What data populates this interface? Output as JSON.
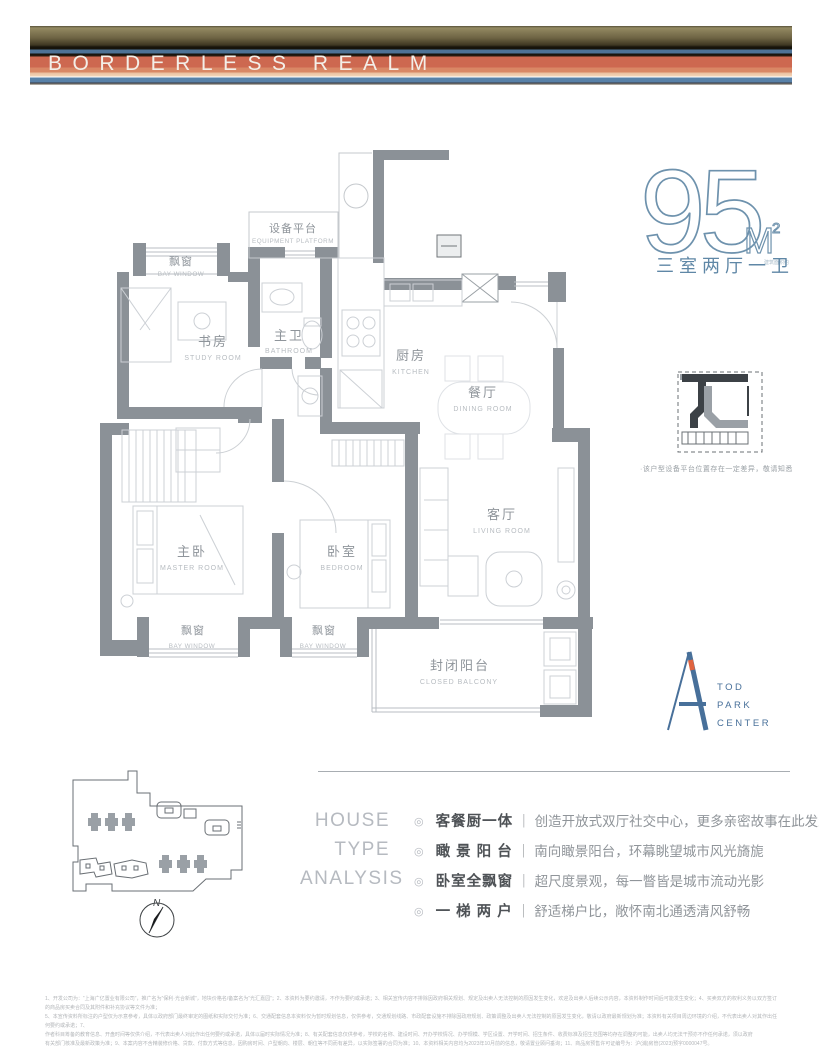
{
  "banner": {
    "title": "BORDERLESS REALM"
  },
  "area": {
    "number": "95",
    "unit_m": "M",
    "unit_sup": "2",
    "unit_note": "建筑面积约",
    "layout": "三室两厅一卫"
  },
  "plan": {
    "equipment": {
      "cn": "设备平台",
      "en": "EQUIPMENT PLATFORM"
    },
    "bay_top": {
      "cn": "飘窗",
      "en": "BAY WINDOW"
    },
    "study": {
      "cn": "书房",
      "en": "STUDY ROOM"
    },
    "bathroom": {
      "cn": "主卫",
      "en": "BATHROOM"
    },
    "kitchen": {
      "cn": "厨房",
      "en": "KITCHEN"
    },
    "dining": {
      "cn": "餐厅",
      "en": "DINING ROOM"
    },
    "living": {
      "cn": "客厅",
      "en": "LIVING ROOM"
    },
    "master": {
      "cn": "主卧",
      "en": "MASTER ROOM"
    },
    "bedroom": {
      "cn": "卧室",
      "en": "BEDROOM"
    },
    "bay_left": {
      "cn": "飘窗",
      "en": "BAY WINDOW"
    },
    "bay_mid": {
      "cn": "飘窗",
      "en": "BAY WINDOW"
    },
    "balcony": {
      "cn": "封闭阳台",
      "en": "CLOSED BALCONY"
    }
  },
  "detail_note": "·该户型设备平台位置存在一定差异，敬请知悉",
  "logo": {
    "line1": "TOD",
    "line2": "PARK",
    "line3": "CENTER"
  },
  "compass": {
    "label": "N"
  },
  "analysis": {
    "title_lines": [
      "HOUSE",
      "TYPE",
      "ANALYSIS"
    ],
    "separator": "｜",
    "bullet": "◎",
    "items": [
      {
        "title": "客餐厨一体",
        "desc": "创造开放式双厅社交中心，更多亲密故事在此发生"
      },
      {
        "title": "瞰 景 阳 台",
        "desc": "南向瞰景阳台，环幕眺望城市风光旖旎"
      },
      {
        "title": "卧室全飘窗",
        "desc": "超尺度景观，每一瞥皆是城市流动光影"
      },
      {
        "title": "一 梯 两 户",
        "desc": "舒适梯户比，敞怀南北通透清风舒畅"
      }
    ]
  },
  "disclaimer": {
    "lines": [
      "1、开发公司为：“上海广亿置业有限公司”，推广名为“保利·光合新城”，地块价格名/备案名为“光汇嘉园”；2、本资料为要约邀请，不作为要约或承诺；3、相关宣传内容不排除因政府相关规划、规定及出卖人无法控制的原因发生变化，欢迎及出卖人后续公示内容，本资料制作时间后可能发生变化；4、买卖双方的权利义务以双方签订的商品房买卖合同及其附件和补充协议等文件为准；",
      "5、本宣传资料所标注的户型仅为示意参考，具体以政府部门最终审定的图纸和实际交付为准；6、交通配套信息本资料仅为暂时规划信息，仅供参考，交通规划线路、市政配套设施不排除因政府规划、政策调整及出卖人无法控制的原因发生变化，敬请以政府最新规划为准；本资料有关项目周边环境的介绍，不代表出卖人对其作出任何要约或承诺；7、",
      "作者科目筹备的教育信息、开盘时间等仅供介绍，不代表出卖人对此作出任何要约或承诺，具体以届时实际情况为准；8、有关配套信息仅供参考，学校的名称、建设时间、开办学校情况、办学规模、学区设置、开学时间、招生条件、收费标准及招生范围等均存在调整的可能，出卖人均无法干预亦不作任何承诺，须以政府",
      "有关部门核准及最新政策为准；9、本案内容不含精装修价格、贷款、付款方式等信息，因购房时间、户型朝向、楼层、朝位等不同而有差异，以实际签署的合同为准；10、本资料相关内容均为2023年10月前的信息，敬请置业顾问垂询；11、商品房预售许可证编号为：沪(浦)房管(2023)预字0000047号。"
    ]
  }
}
